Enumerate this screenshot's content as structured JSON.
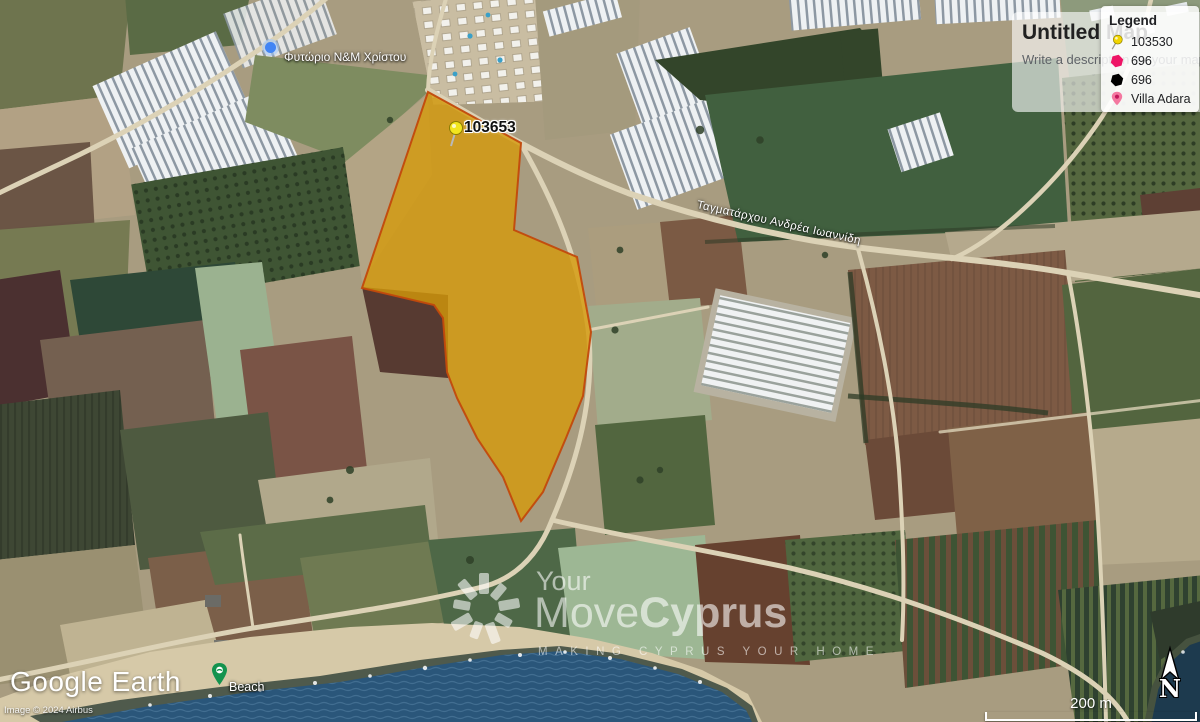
{
  "map": {
    "parcel_pin_label": "103653",
    "parcel_fill_color": "#d49a0a",
    "parcel_border_color": "#c2490c",
    "pin_color": "#f2e51e",
    "nursery_label": "Φυτώριο N&M Χρίστου",
    "road_label": "Ταγματάρχου Ανδρέα Ιωαννίδη",
    "beach_label": "Beach"
  },
  "panel": {
    "title": "Untitled Map",
    "description_placeholder": "Write a description for your map.",
    "legend": {
      "heading": "Legend",
      "items": [
        {
          "icon": "pushpin-icon",
          "color": "#f2d500",
          "label": "103530"
        },
        {
          "icon": "polygon-icon",
          "color": "#ee1566",
          "label": "696"
        },
        {
          "icon": "polygon-icon",
          "color": "#000000",
          "label": "696"
        },
        {
          "icon": "place-pin-icon",
          "color": "#f478a0",
          "label": "Villa Adara"
        }
      ]
    }
  },
  "watermark": {
    "line1": "Your",
    "brand_light": "Move",
    "brand_bold": "Cyprus",
    "tagline": "MAKING CYPRUS YOUR HOME"
  },
  "attribution": {
    "logo_word1": "Google",
    "logo_word2": "Earth",
    "copyright": "Image © 2024 Airbus"
  },
  "controls": {
    "north": "N",
    "scale": "200 m"
  }
}
